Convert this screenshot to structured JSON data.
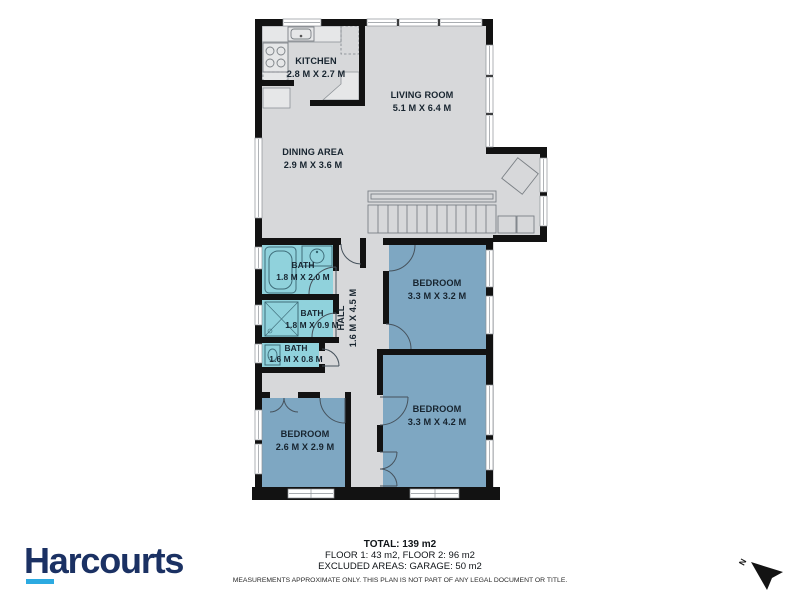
{
  "plan": {
    "rooms": {
      "kitchen": {
        "name": "KITCHEN",
        "dims": "2.8 M X 2.7 M"
      },
      "living": {
        "name": "LIVING ROOM",
        "dims": "5.1 M X 6.4 M"
      },
      "dining": {
        "name": "DINING AREA",
        "dims": "2.9 M X 3.6 M"
      },
      "bath_1": {
        "name": "BATH",
        "dims": "1.8 M X 2.0 M"
      },
      "bath_2": {
        "name": "BATH",
        "dims": "1.8 M X 0.9 M"
      },
      "bath_3": {
        "name": "BATH",
        "dims": "1.6 M X 0.8 M"
      },
      "hall": {
        "name": "HALL",
        "dims": "1.6 M X 4.5 M"
      },
      "bedroom_1": {
        "name": "BEDROOM",
        "dims": "3.3 M X 3.2 M"
      },
      "bedroom_2": {
        "name": "BEDROOM",
        "dims": "3.3 M X 4.2 M"
      },
      "bedroom_3": {
        "name": "BEDROOM",
        "dims": "2.6 M X 2.9 M"
      }
    },
    "compass": {
      "label": "N"
    }
  },
  "footer": {
    "brand": "Harcourts",
    "total": "TOTAL: 139 m2",
    "floors": "FLOOR 1: 43 m2, FLOOR 2: 96 m2",
    "excluded": "EXCLUDED AREAS: GARAGE: 50 m2",
    "disclaimer": "MEASUREMENTS APPROXIMATE ONLY. THIS PLAN IS NOT PART OF ANY LEGAL DOCUMENT OR TITLE."
  },
  "colors": {
    "wall": "#121212",
    "floor": "#d7d8da",
    "bath": "#90d2dc",
    "bedroom": "#7ea7c2",
    "counter": "#e6e7e8",
    "brand_navy": "#1b3163",
    "brand_blue": "#2caae1"
  }
}
